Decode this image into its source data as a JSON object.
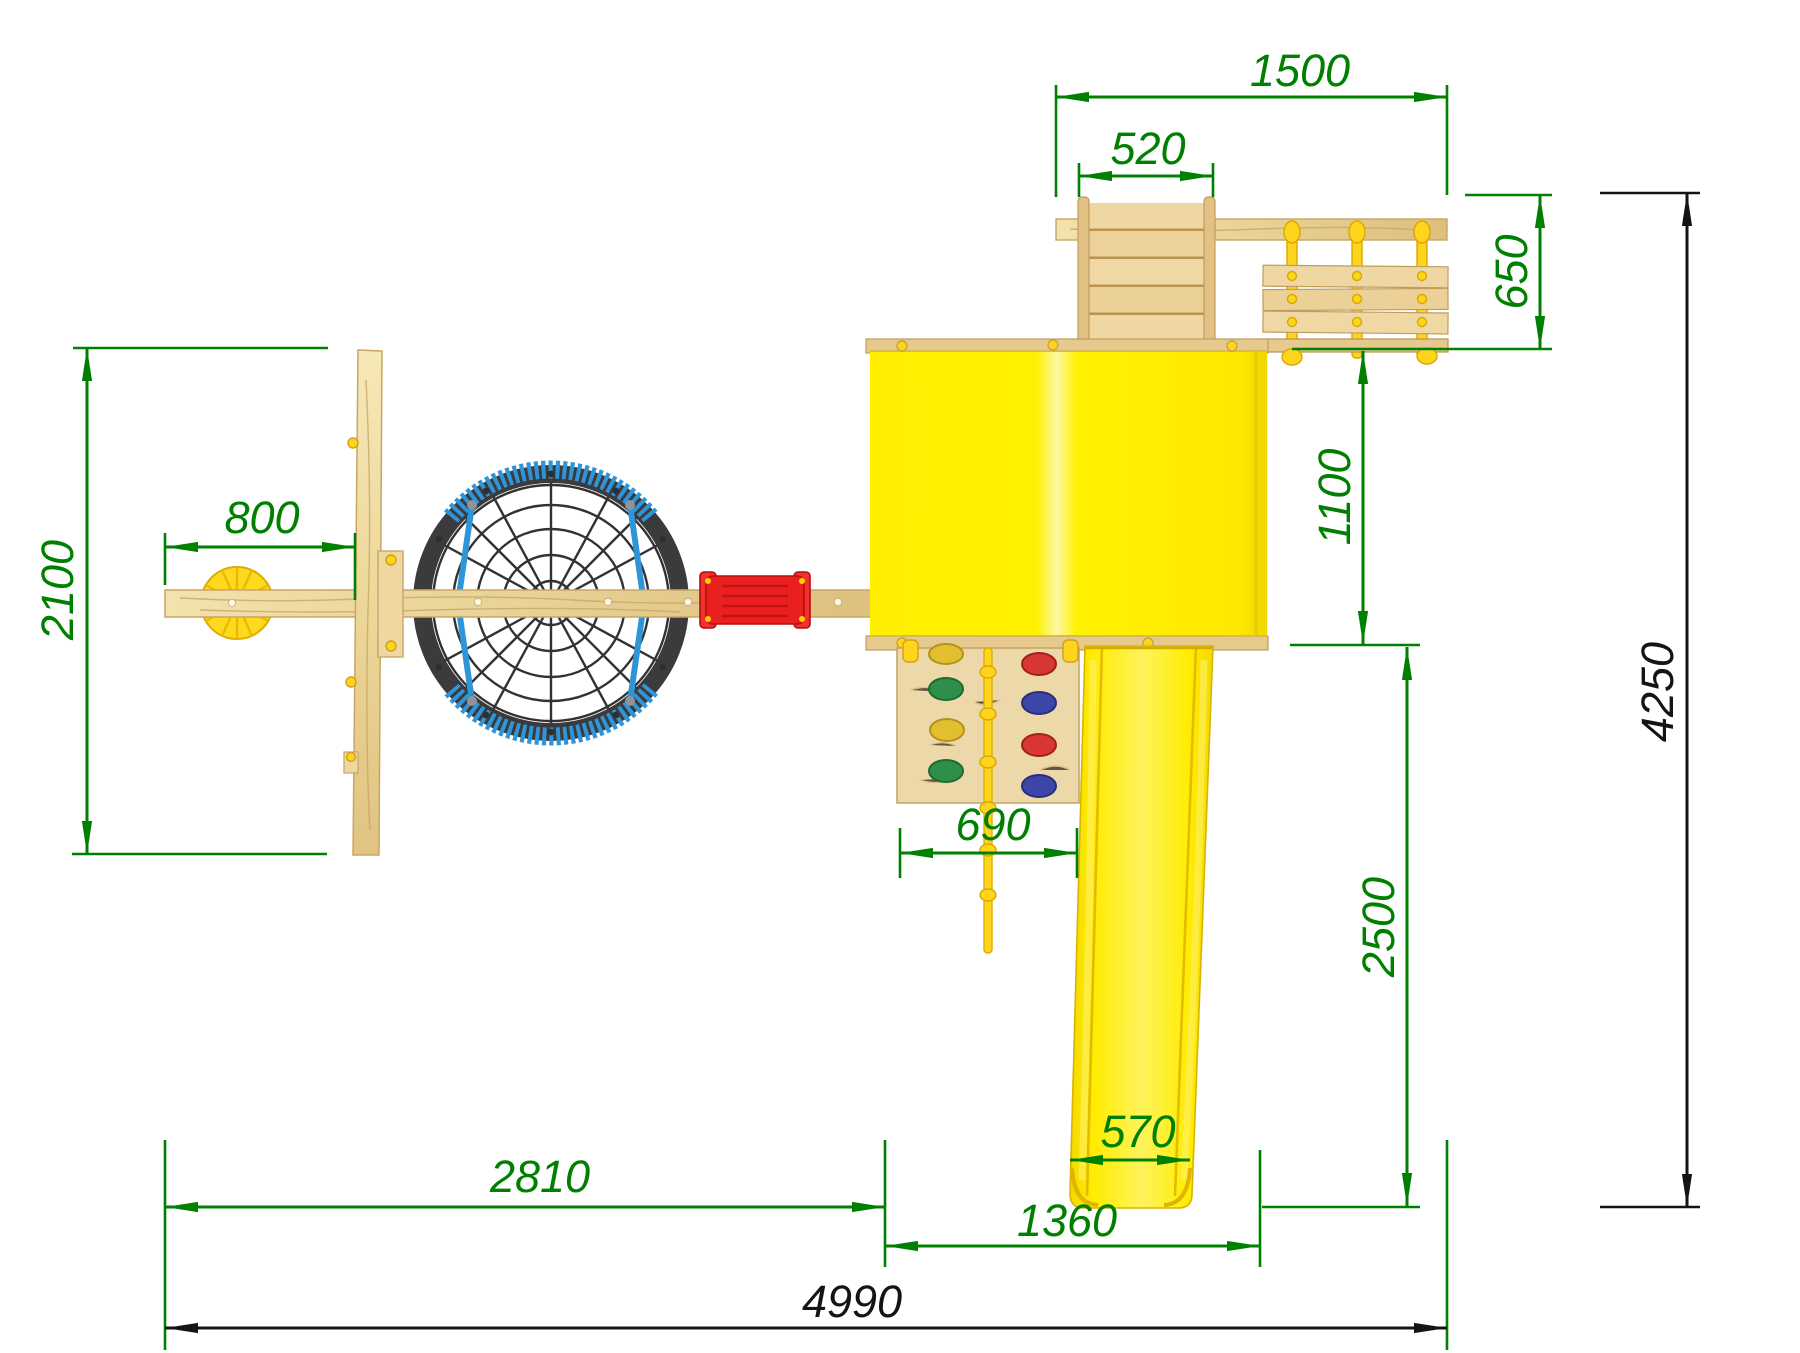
{
  "drawing": {
    "subject": "playground-set-top-view",
    "units_shown": false
  },
  "dimensions": {
    "top_assembly_length": {
      "label": "1500"
    },
    "ramp_width": {
      "label": "520"
    },
    "top_assembly_depth": {
      "label": "650"
    },
    "swing_frame_depth": {
      "label": "2100"
    },
    "disc_swing_offset": {
      "label": "800"
    },
    "tower_depth": {
      "label": "1100"
    },
    "climbing_wall_width": {
      "label": "690"
    },
    "slide_run_length": {
      "label": "2500"
    },
    "slide_width": {
      "label": "570"
    },
    "swing_section_length": {
      "label": "2810"
    },
    "tower_section_length": {
      "label": "1360"
    },
    "overall_length": {
      "label": "4990"
    },
    "overall_depth": {
      "label": "4250"
    }
  },
  "colors": {
    "dimension_accent": "#008000",
    "dimension_overall": "#141414",
    "wood_light": "#f1e0a8",
    "wood_mid": "#e7cf92",
    "wood_edge": "#c9a566",
    "tower_yellow": "#ffec00",
    "ridge_highlight": "#fbf7a8",
    "slide_rail_yellow": "#f3d900",
    "rope_yellow": "#ffd41c",
    "seat_red": "#e92020",
    "nest_ring_dark": "#3b3b3d",
    "nest_rope_blue": "#2e96d8",
    "hold_red": "#d93636",
    "hold_blue": "#3c46a8",
    "hold_yellow": "#e2bf2e",
    "hold_green": "#2e8f4a",
    "disc_yellow": "#ffd91e"
  }
}
